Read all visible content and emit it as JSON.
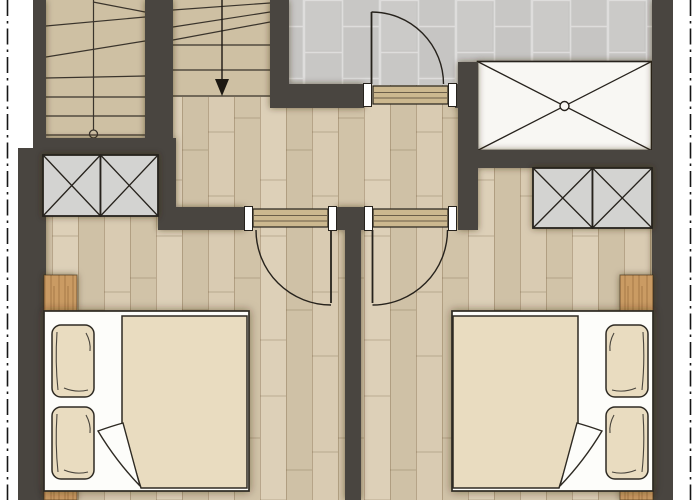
{
  "palette": {
    "page_bg": "#ffffff",
    "wall": "#4a4540",
    "line_dark": "#342f28",
    "wood_a": "#d9cbb2",
    "wood_b": "#d1c3a8",
    "wood_c": "#ddd0b8",
    "wood_d": "#cfc1a6",
    "stair_tread": "#cec0a3",
    "tile": "#c8c7c5",
    "tile_joint": "#dedddc",
    "cabinet_fill": "#d3d3d1",
    "shower_fill": "#f8f7f3",
    "textile": "#e9dcc0",
    "linen_white": "#fdfdfa",
    "door_wood": "#ccb88f",
    "night_wood": "#ca9b63",
    "boundary": "#161616"
  },
  "plan": {
    "type": "architectural-floor-plan",
    "visible_text": [],
    "rooms": [
      "stairwell",
      "bathroom",
      "hallway",
      "bedroom-left",
      "bedroom-right"
    ],
    "fixtures": [
      "u-staircase-two-flights",
      "stair-walk-line-start-circle",
      "stair-walk-line-arrow-down",
      "shower-tray-with-center-drain",
      "wardrobe-two-door-left",
      "wardrobe-two-door-right",
      "hinged-door-bathroom",
      "hinged-door-bedroom-left",
      "hinged-door-bedroom-right",
      "double-bed-left-with-duvet-fold",
      "double-bed-right-with-duvet-fold",
      "pillows-x4",
      "nightstand-top-left",
      "nightstand-bottom-left",
      "nightstand-top-right",
      "nightstand-bottom-right",
      "boundary-dash-dot-line-left",
      "boundary-dash-dot-line-right"
    ]
  }
}
